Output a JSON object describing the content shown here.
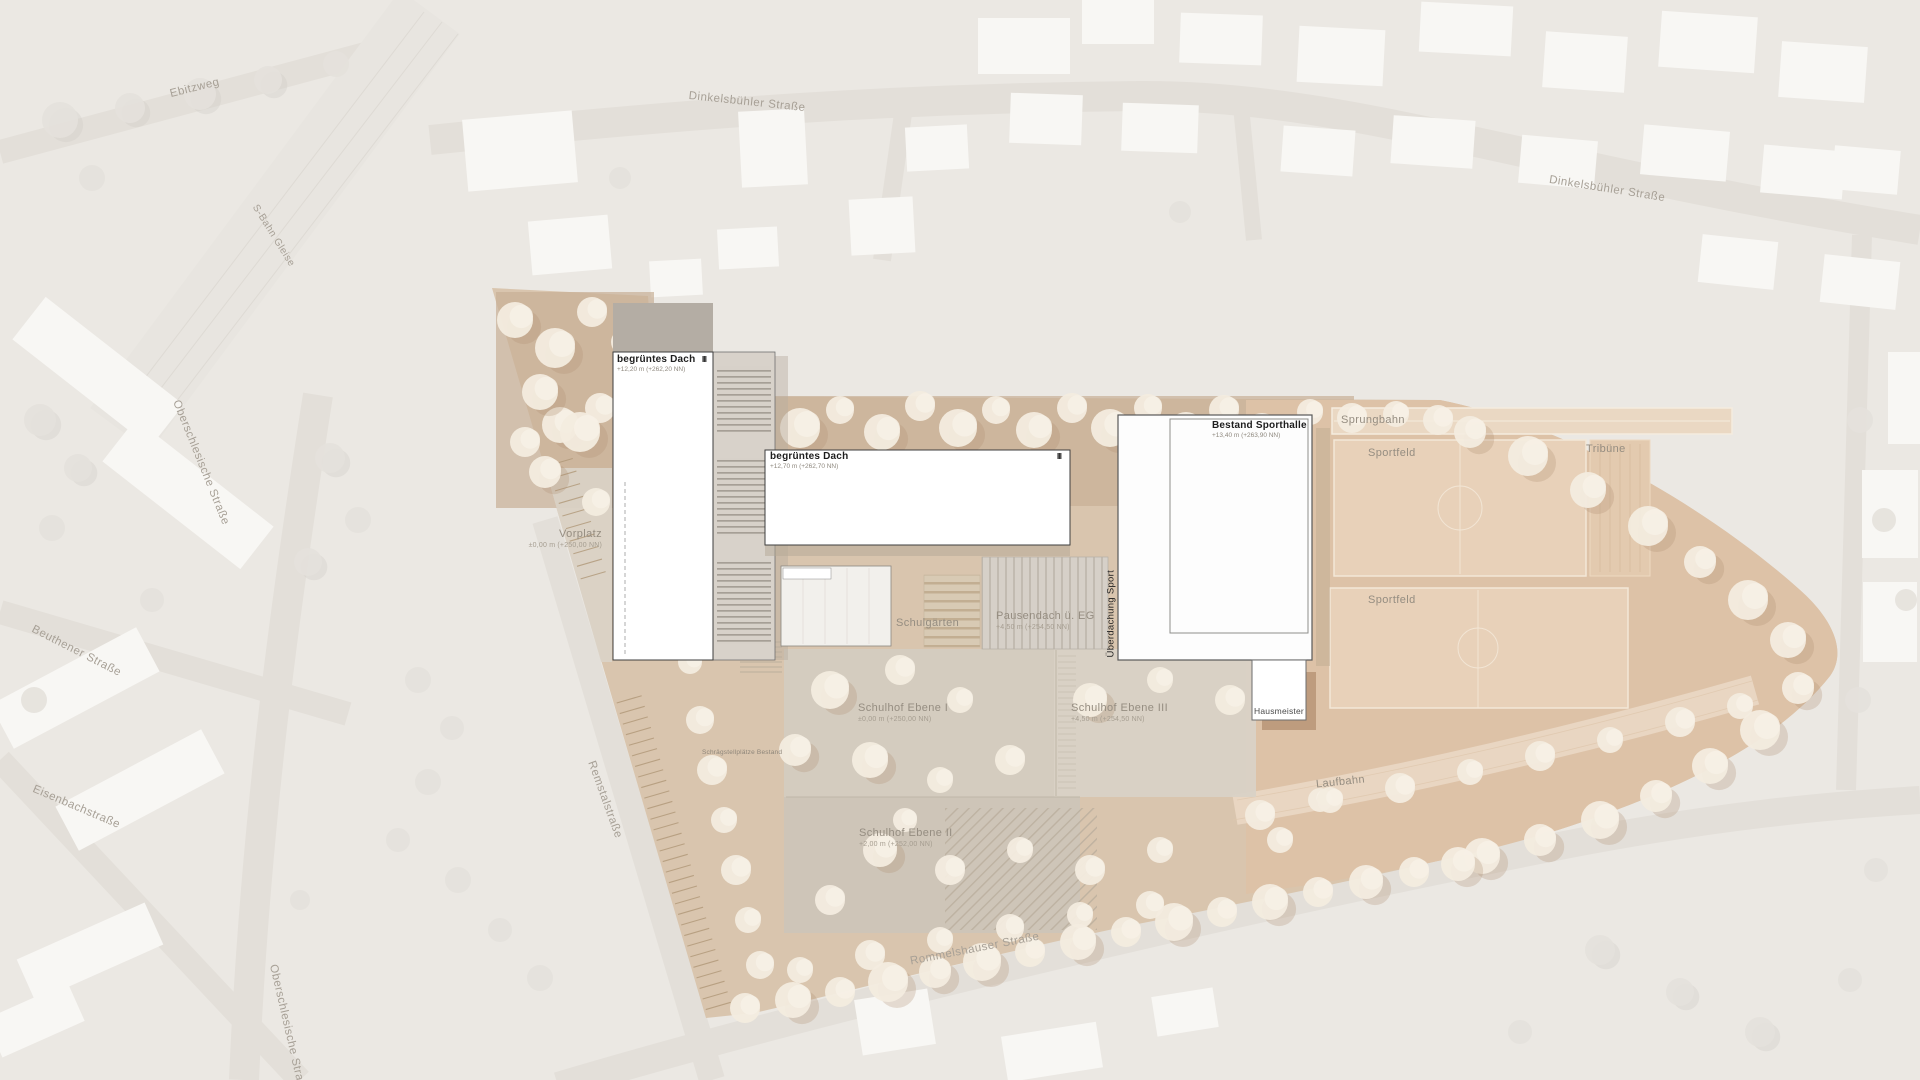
{
  "streets": {
    "ebitzweg": "Ebitzweg",
    "dinkelsbuehler_1": "Dinkelsbühler Straße",
    "dinkelsbuehler_2": "Dinkelsbühler Straße",
    "sbahn_gleise": "S-Bahn Gleise",
    "oberschlesische_1": "Oberschlesische Straße",
    "beuthener": "Beuthener Straße",
    "eisenbach": "Eisenbachstraße",
    "oberschlesische_2": "Oberschlesische Straße",
    "remstal": "Remstalstraße",
    "rommelshauser": "Rommelshauser Straße"
  },
  "buildings": {
    "school_a": {
      "title": "begrüntes Dach",
      "elevation": "+12,20 m (+262,20 NN)",
      "storeys": "III"
    },
    "school_b": {
      "title": "begrüntes Dach",
      "elevation": "+12,70 m (+262,70 NN)",
      "storeys": "III"
    },
    "sporthalle": {
      "title": "Bestand Sporthalle",
      "elevation": "+13,40 m (+263,90 NN)"
    },
    "ueberdachung_sport": {
      "title": "Überdachung Sport"
    },
    "hausmeister": {
      "title": "Hausmeister"
    }
  },
  "areas": {
    "vorplatz": {
      "title": "Vorplatz",
      "elevation": "±0,00 m (+250,00 NN)"
    },
    "schulgaerten": {
      "title": "Schulgärten"
    },
    "pausendach": {
      "title": "Pausendach ü. EG",
      "elevation": "+4,50 m (+254,50 NN)"
    },
    "schulhof_1": {
      "title": "Schulhof Ebene I",
      "elevation": "±0,00 m (+250,00 NN)"
    },
    "schulhof_2": {
      "title": "Schulhof Ebene II",
      "elevation": "+2,00 m (+252,00 NN)"
    },
    "schulhof_3": {
      "title": "Schulhof Ebene III",
      "elevation": "+4,50 m (+254,50 NN)"
    },
    "sprungbahn": {
      "title": "Sprungbahn"
    },
    "sportfeld_nord": {
      "title": "Sportfeld"
    },
    "tribuene": {
      "title": "Tribüne"
    },
    "sportfeld_sued": {
      "title": "Sportfeld"
    },
    "laufbahn": {
      "title": "Laufbahn"
    },
    "stellplaetze": {
      "title": "Schrägstellplätze Bestand"
    }
  },
  "colors": {
    "background": "#ebe8e3",
    "street": "#e3dfd9",
    "site_ground": "#d8c3ab",
    "north_band": "#c7af95",
    "sport_ground": "#ddc2a7",
    "field": "#e8d1b9",
    "building_fill": "#ffffff",
    "tree_site": "#f3ecdf",
    "tree_background": "#e4e1db"
  }
}
